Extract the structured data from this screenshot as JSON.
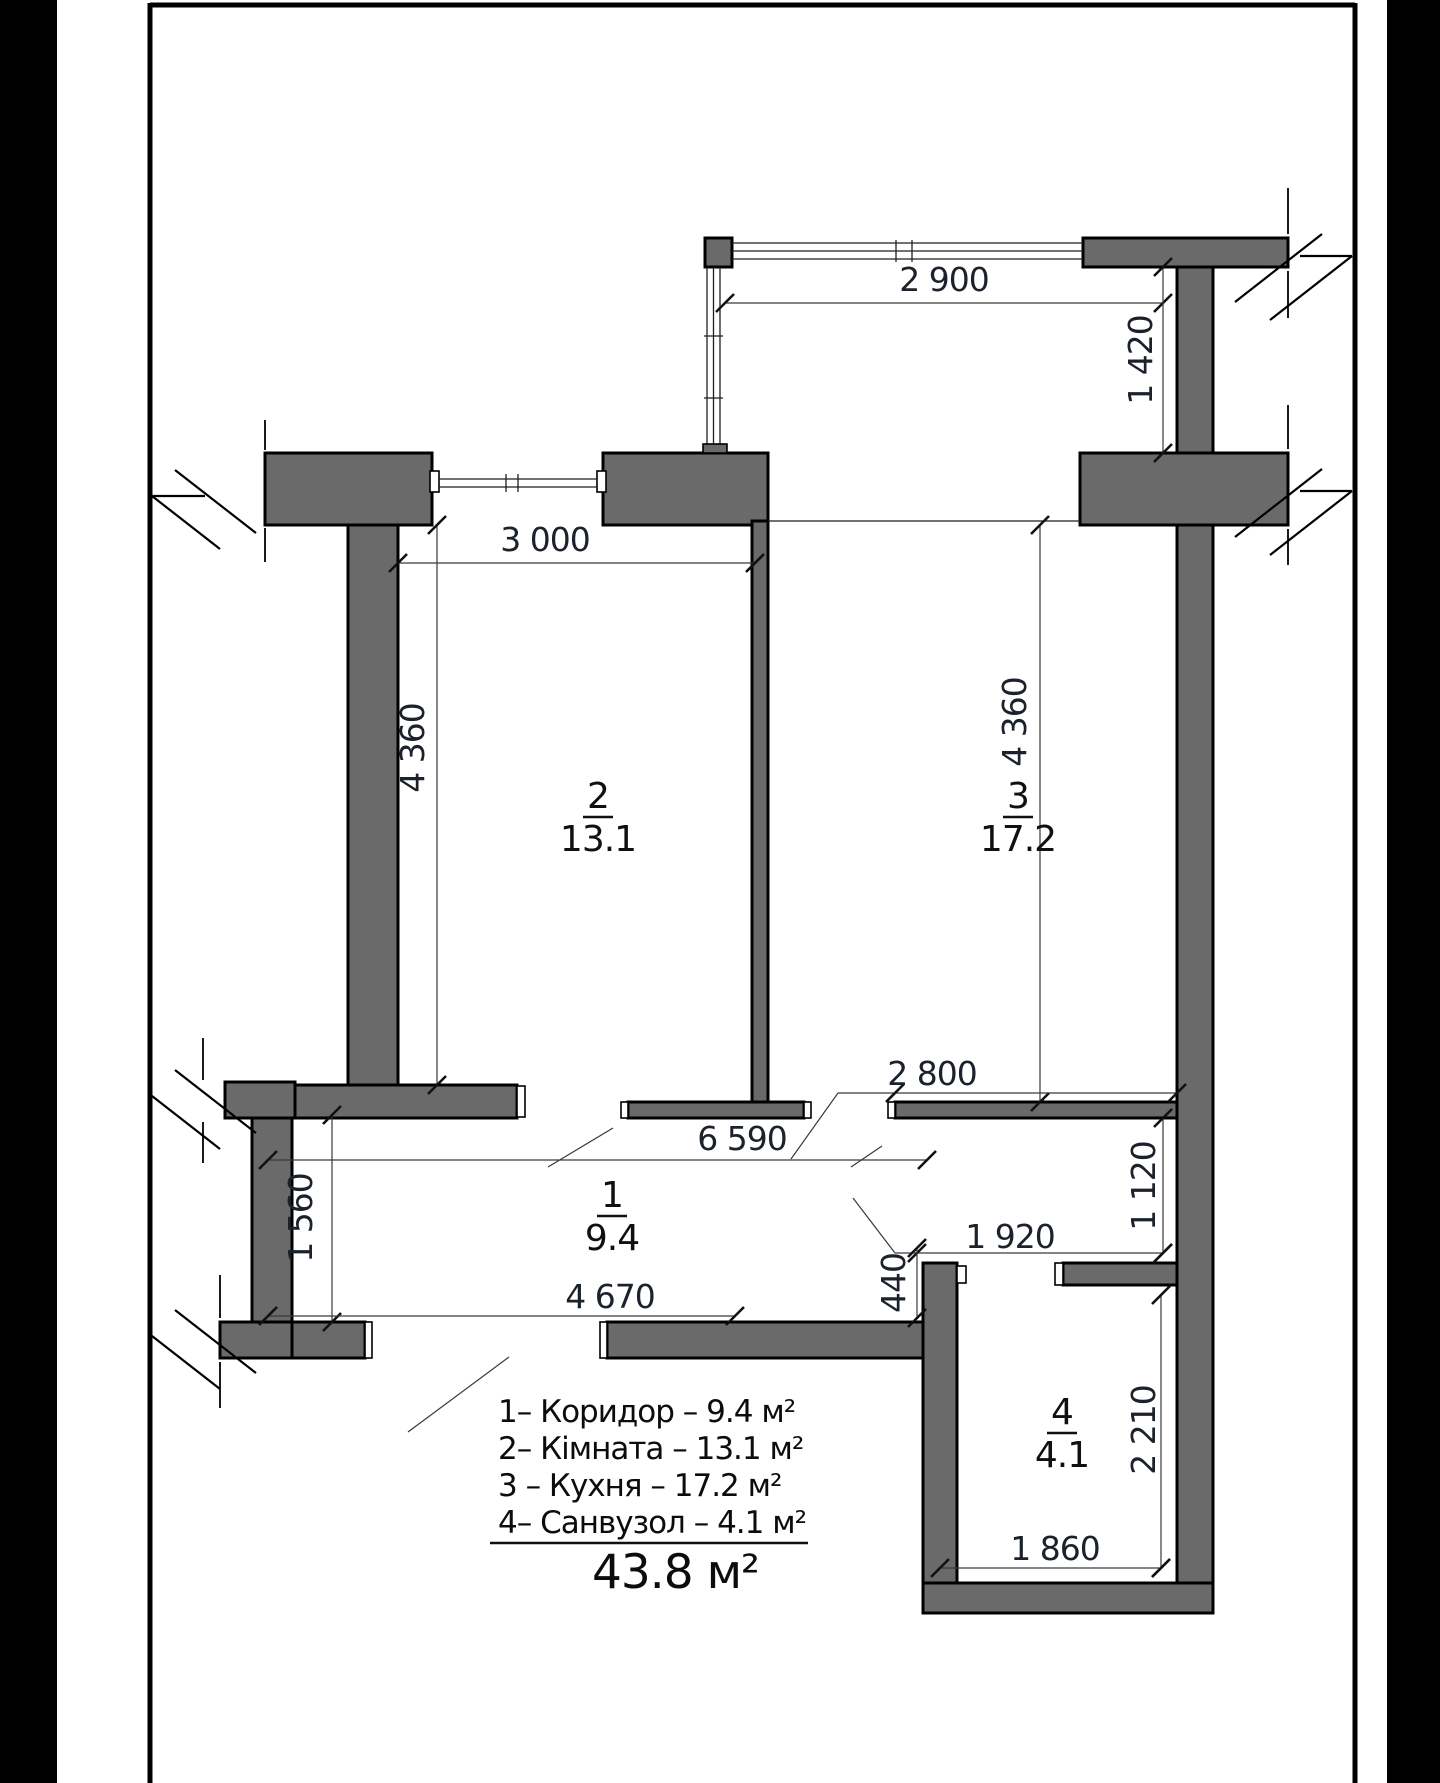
{
  "plan": {
    "rooms": [
      {
        "number": "1",
        "area": "9.4"
      },
      {
        "number": "2",
        "area": "13.1"
      },
      {
        "number": "3",
        "area": "17.2"
      },
      {
        "number": "4",
        "area": "4.1"
      }
    ],
    "dims": {
      "balcony_width": "2 900",
      "balcony_depth": "1 420",
      "room2_width": "3 000",
      "room2_height": "4 360",
      "kitchen_height": "4 360",
      "kitchen_wall": "2 800",
      "hall_span": "6 590",
      "kitchen_right_gap": "1 120",
      "hall_left_height": "1 560",
      "bath_top_width": "1 920",
      "wall_offset": "440",
      "hall_bottom_width": "4 670",
      "bath_right_height": "2 210",
      "bath_bottom_width": "1 860"
    },
    "legend": {
      "items": [
        "1– Коридор  – 9.4 м²",
        "2– Кімната – 13.1 м²",
        "3 – Кухня   – 17.2 м²",
        "4– Санвузол – 4.1 м²"
      ],
      "total": "43.8 м²"
    }
  }
}
